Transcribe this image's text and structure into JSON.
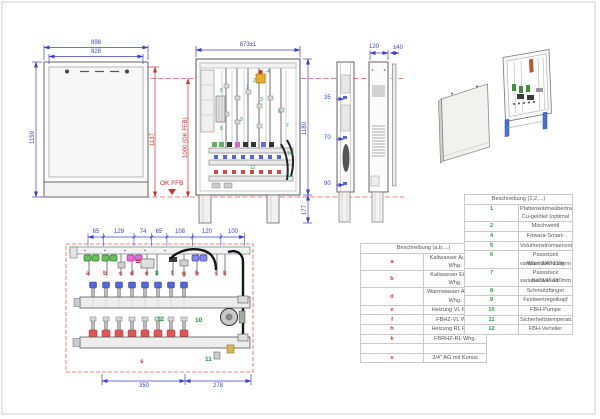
{
  "colors": {
    "dim_blue": "#3f3fd0",
    "dim_red": "#d03030",
    "part_green": "#1f9e3e"
  },
  "front_view": {
    "w_outer": "898",
    "w_inner": "828",
    "h_left": "1159",
    "h_right": "1137",
    "ffb_dim": "1000 (OK FFB)",
    "ffb_label": "OK FFB"
  },
  "open_view": {
    "w": "873±1",
    "h": "1180",
    "base": "177",
    "parts": [
      "1",
      "2",
      "3",
      "4",
      "5",
      "6",
      "7",
      "8",
      "9",
      "10",
      "11",
      "12"
    ]
  },
  "side_view": {
    "depth": "120",
    "door_gap": "±40",
    "p35": "35",
    "p70": "70",
    "p90": "90"
  },
  "detail_view": {
    "top_dims": [
      "65",
      "129",
      "74",
      "65",
      "108",
      "120",
      "100"
    ],
    "bottom_dims": [
      "350",
      "278"
    ],
    "ports": [
      "a",
      "b",
      "c",
      "d",
      "e",
      "f",
      "g",
      "h",
      "i",
      "k"
    ],
    "n8": "8",
    "n10": "10",
    "n11": "11",
    "n12": "12",
    "s": "s"
  },
  "tables": {
    "letters": {
      "header": "Beschreibung (a,b,...)",
      "rows": [
        {
          "key": "a",
          "desc": "Kaltwasser Ausgang Whg."
        },
        {
          "key": "b",
          "desc": "Kaltwasser Eingang Whg."
        },
        {
          "key": "d",
          "desc": "Warmwasser Ausgang Whg."
        },
        {
          "key": "e",
          "desc": "Heizung VL Primär"
        },
        {
          "key": "f",
          "desc": "FBHZ-VL Whg."
        },
        {
          "key": "h",
          "desc": "Heizung RL Primär"
        },
        {
          "key": "k",
          "desc": "FBRHZ-RL Whg."
        },
        {
          "key": "",
          "desc": ""
        },
        {
          "key": "s",
          "desc": "3/4\" AG mit Konus"
        }
      ]
    },
    "numbers": {
      "header": "Beschreibung (1,2,...)",
      "rows": [
        {
          "key": "1",
          "desc": "Plattenwärmeübertrager",
          "desc2": "Cu-gelötet (optimal VA-gelötet)"
        },
        {
          "key": "2",
          "desc": "Mischventil"
        },
        {
          "key": "4",
          "desc": "Friwara-Smart-Regler"
        },
        {
          "key": "5",
          "desc": "Volumenstromsensor"
        },
        {
          "key": "6",
          "desc": "Passstück Wärmezählung",
          "desc2": "variabel 3/4\"-110mm bzw. 1\"-130mm"
        },
        {
          "key": "7",
          "desc": "Passstück Kaltwasser",
          "desc2": "variabel 3/4\"-110mm bzw. 1\"-130mm"
        },
        {
          "key": "8",
          "desc": "Schmutzfänger"
        },
        {
          "key": "9",
          "desc": "Festwertregelkopf"
        },
        {
          "key": "10",
          "desc": "FBH-Pumpe"
        },
        {
          "key": "11",
          "desc": "Sicherheitstemperaturwächter"
        },
        {
          "key": "12",
          "desc": "FBH-Verteiler"
        }
      ]
    }
  }
}
